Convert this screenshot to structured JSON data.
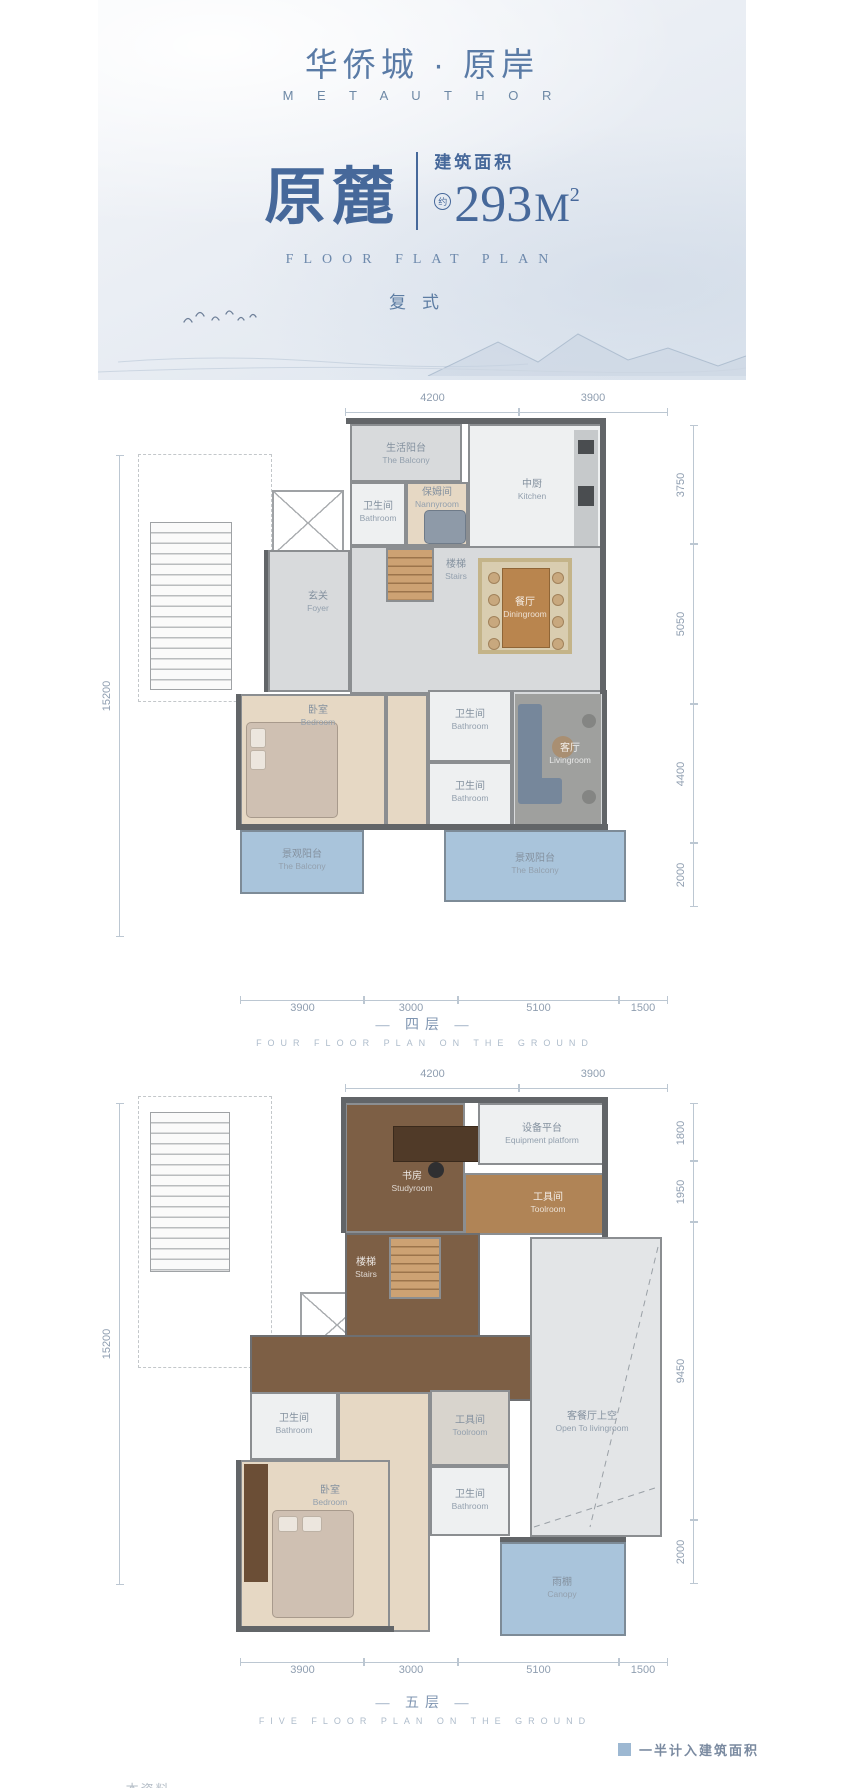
{
  "header": {
    "logo_cn": "华侨城 · 原岸",
    "logo_en": "M E T A U T H O R",
    "unit_name": "原麓",
    "area_label": "建筑面积",
    "area_approx": "约",
    "area_value": "293",
    "area_unit": "M",
    "area_sup": "2",
    "plan_label_en": "FLOOR FLAT PLAN",
    "plan_type": "复式"
  },
  "floor4": {
    "title": "— 四层 —",
    "subtitle": "FOUR FLOOR PLAN ON THE GROUND",
    "dims_top": [
      "4200",
      "3900"
    ],
    "dims_right": [
      "3750",
      "5050",
      "4400",
      "2000"
    ],
    "dims_bottom": [
      "3900",
      "3000",
      "5100",
      "1500"
    ],
    "dim_left": "15200",
    "rooms": {
      "life_balcony": {
        "cn": "生活阳台",
        "en": "The Balcony"
      },
      "bathroom_a": {
        "cn": "卫生间",
        "en": "Bathroom"
      },
      "nannyroom": {
        "cn": "保姆间",
        "en": "Nannyroom"
      },
      "kitchen": {
        "cn": "中厨",
        "en": "Kitchen"
      },
      "stairs": {
        "cn": "楼梯",
        "en": "Stairs"
      },
      "dining": {
        "cn": "餐厅",
        "en": "Diningroom"
      },
      "foyer": {
        "cn": "玄关",
        "en": "Foyer"
      },
      "bedroom": {
        "cn": "卧室",
        "en": "Bedroom"
      },
      "bathroom_b": {
        "cn": "卫生间",
        "en": "Bathroom"
      },
      "bathroom_c": {
        "cn": "卫生间",
        "en": "Bathroom"
      },
      "living": {
        "cn": "客厅",
        "en": "Livingroom"
      },
      "view_balcony_l": {
        "cn": "景观阳台",
        "en": "The Balcony"
      },
      "view_balcony_r": {
        "cn": "景观阳台",
        "en": "The Balcony"
      }
    }
  },
  "floor5": {
    "title": "— 五层 —",
    "subtitle": "FIVE FLOOR PLAN ON THE GROUND",
    "dims_top": [
      "4200",
      "3900"
    ],
    "dims_right": [
      "1800",
      "1950",
      "9450",
      "2000"
    ],
    "dims_bottom": [
      "3900",
      "3000",
      "5100",
      "1500"
    ],
    "dim_left": "15200",
    "rooms": {
      "study": {
        "cn": "书房",
        "en": "Studyroom"
      },
      "equipment": {
        "cn": "设备平台",
        "en": "Equipment platform"
      },
      "toolroom_a": {
        "cn": "工具间",
        "en": "Toolroom"
      },
      "stairs": {
        "cn": "楼梯",
        "en": "Stairs"
      },
      "void": {
        "cn": "客餐厅上空",
        "en": "Open To livingroom"
      },
      "bathroom_a": {
        "cn": "卫生间",
        "en": "Bathroom"
      },
      "toolroom_b": {
        "cn": "工具间",
        "en": "Toolroom"
      },
      "bathroom_b": {
        "cn": "卫生间",
        "en": "Bathroom"
      },
      "bedroom": {
        "cn": "卧室",
        "en": "Bedroom"
      },
      "canopy": {
        "cn": "雨棚",
        "en": "Canopy"
      }
    }
  },
  "legend": {
    "label": "一半计入建筑面积"
  },
  "footer": {
    "note": "— 本资料……"
  },
  "colors": {
    "accent": "#46689a",
    "dim_text": "#8f9eb0",
    "balcony": "#a9c4db",
    "legend_square": "#9db8d2"
  }
}
